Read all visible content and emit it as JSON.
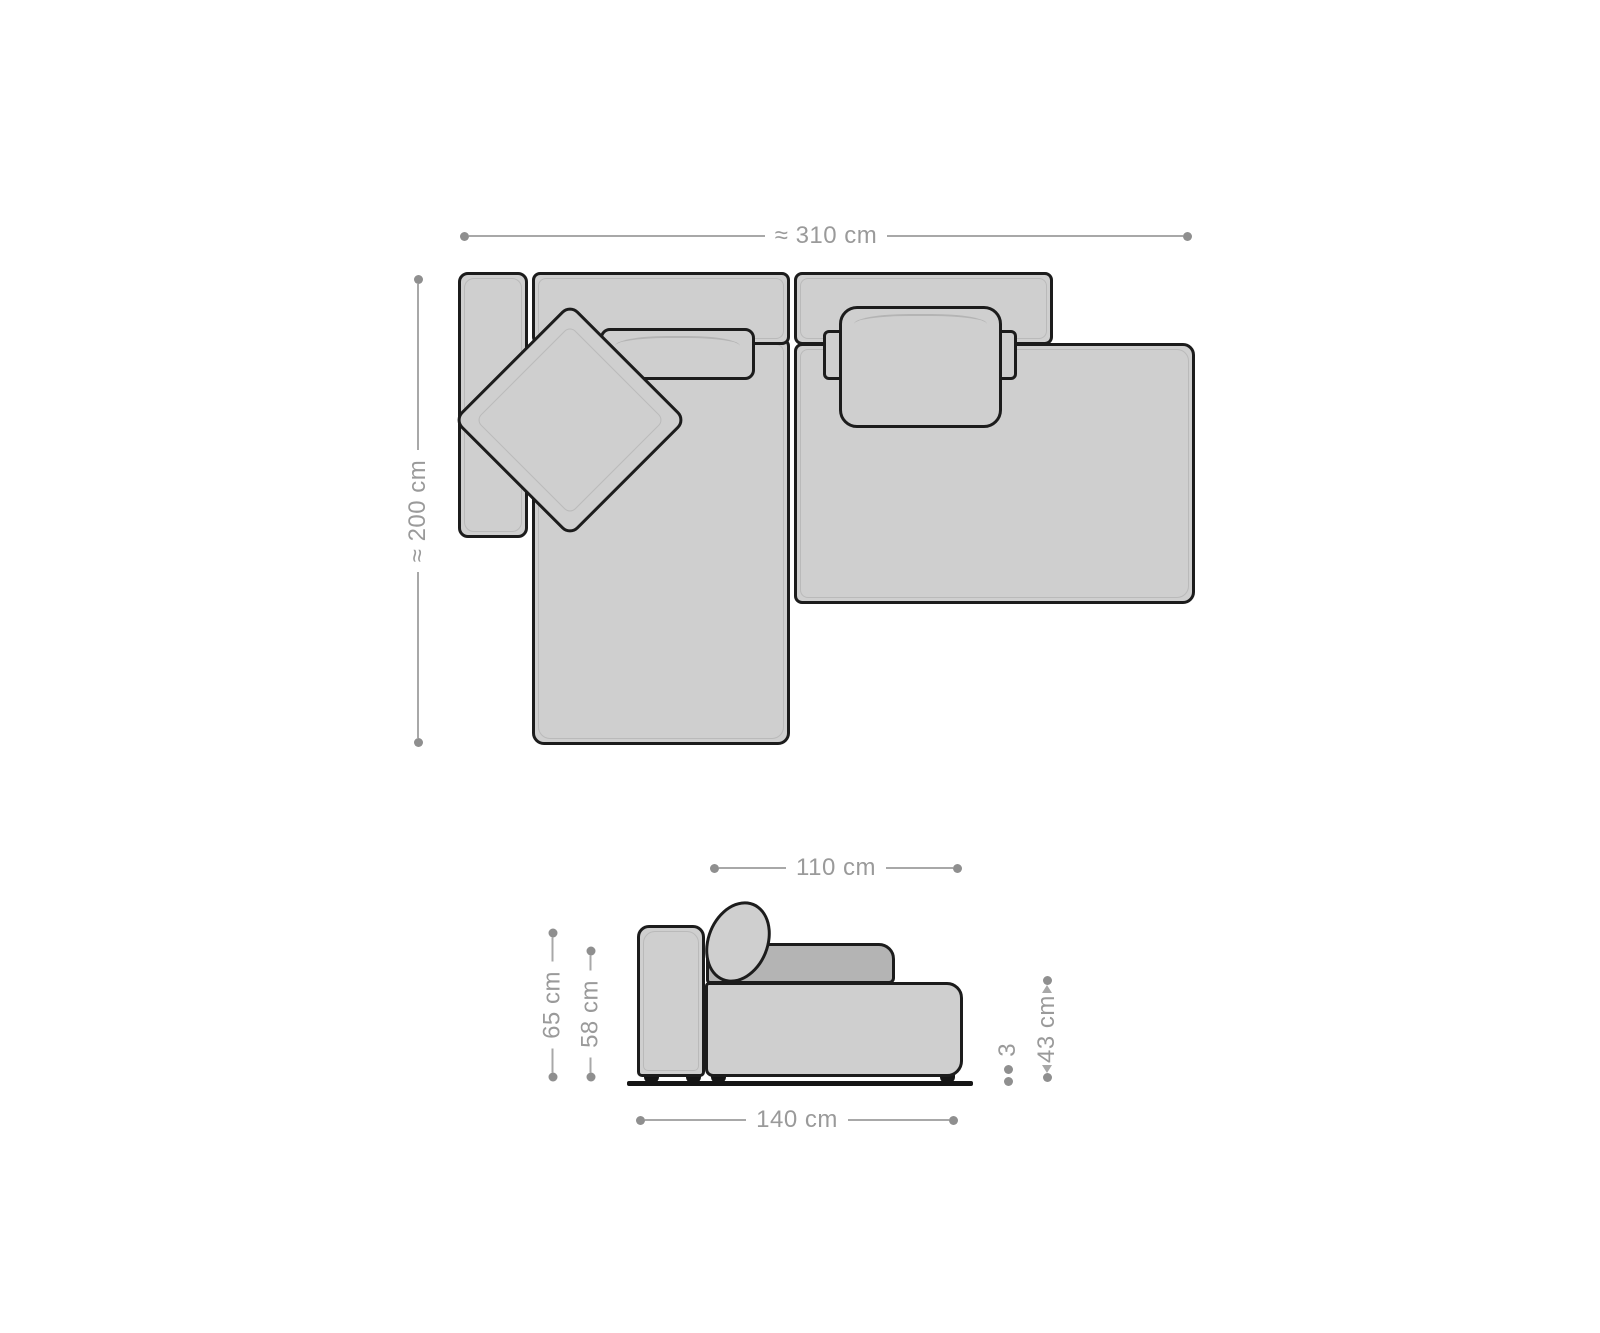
{
  "diagram": {
    "title": "sofa-dimension-drawing",
    "colors": {
      "background": "#ffffff",
      "sofa_fill": "#cfcfcf",
      "sofa_fill_dark": "#b4b4b4",
      "outline": "#1c1c1c",
      "inner_detail": "#a9a9a9",
      "dim_text": "#9a9a9a",
      "dim_line": "#a8a8a8",
      "dim_dot": "#8f8f8f",
      "foot": "#151515"
    },
    "top_view": {
      "width_label": "≈ 310 cm",
      "depth_label": "≈ 200 cm"
    },
    "side_view": {
      "seat_depth_label": "110 cm",
      "total_height_label": "65 cm",
      "back_height_label": "58 cm",
      "seat_height_label": "43 cm",
      "foot_height_label": "3",
      "total_depth_label": "140 cm"
    }
  }
}
